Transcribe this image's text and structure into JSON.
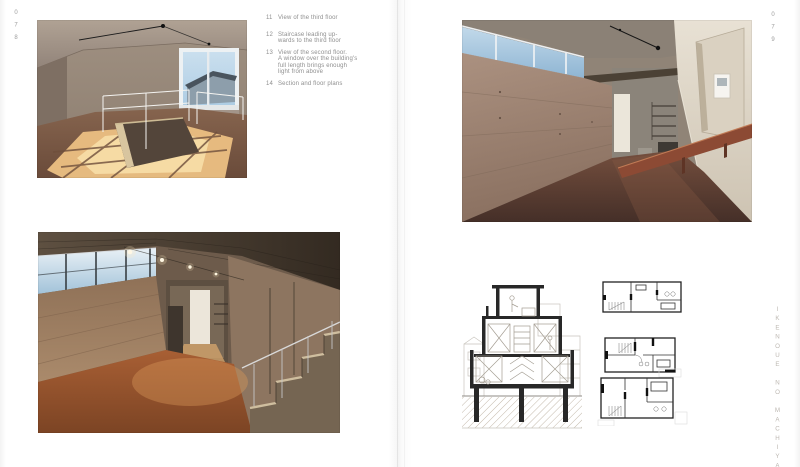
{
  "left_page": {
    "page_number": "078",
    "captions": [
      {
        "num": "11",
        "lines": [
          "View of the third floor"
        ]
      },
      {
        "num": "12",
        "lines": [
          "Staircase leading up-",
          "wards to the third floor"
        ]
      },
      {
        "num": "13",
        "lines": [
          "View of the second floor.",
          "A window over the building's",
          "full length brings enough",
          "light from above"
        ]
      },
      {
        "num": "14",
        "lines": [
          "Section and floor plans"
        ]
      }
    ]
  },
  "right_page": {
    "page_number": "079",
    "side_title": "IKENOUE NO MACHIYA"
  },
  "palette": {
    "paper": "#ffffff",
    "caption_gray": "#8f8f8f",
    "page_number_gray": "#9c9c9c",
    "side_title_gray": "#bdb8b2",
    "concrete": "#9b8878",
    "floor_red": "#a05a35",
    "sky_blue": "#aecde4",
    "sunlight": "#f2cf92",
    "drawing_ink": "#282828"
  }
}
